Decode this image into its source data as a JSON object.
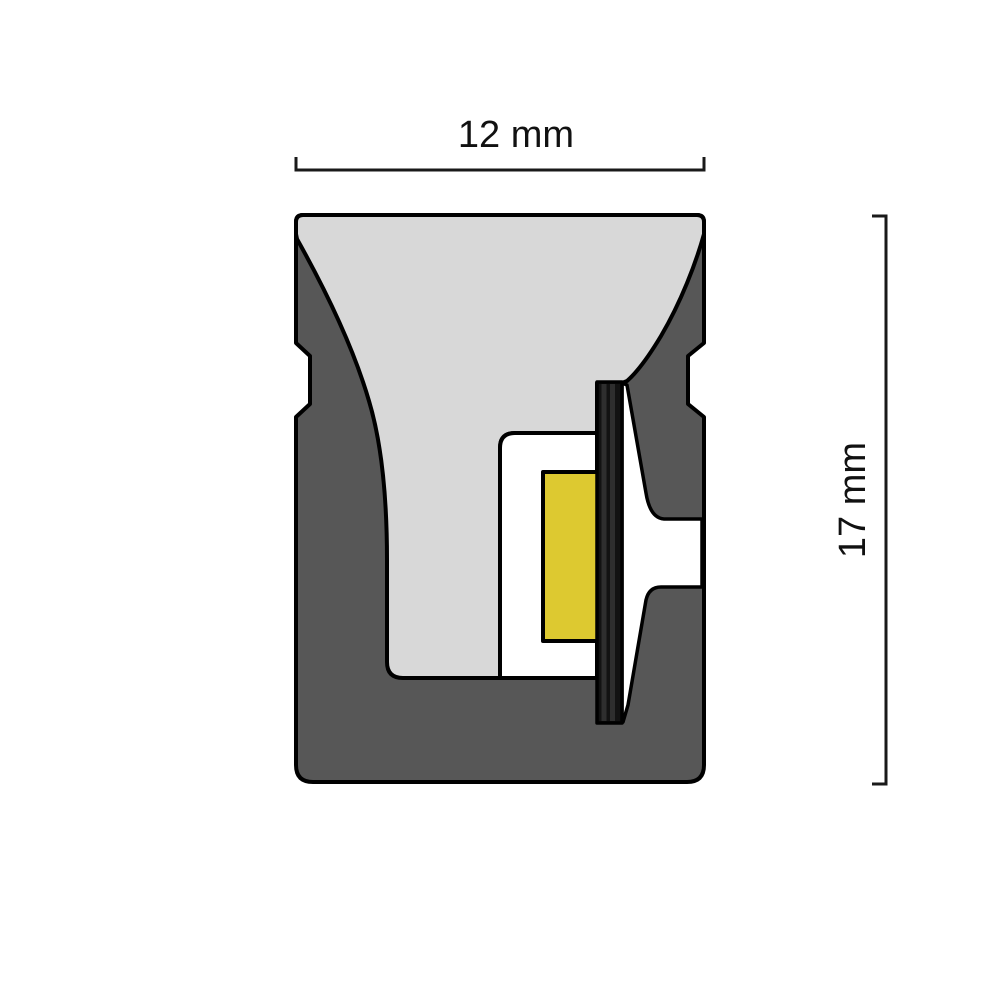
{
  "diagram": {
    "description_label": "led-neon-flex-profile-cross-section",
    "dimensions": {
      "width": {
        "label": "12 mm"
      },
      "height": {
        "label": "17 mm"
      }
    },
    "colors": {
      "background": "#ffffff",
      "outline": "#000000",
      "body_gray": "#575757",
      "diffuser_gray": "#d8d8d8",
      "cavity_white": "#ffffff",
      "led_yellow": "#ddc930",
      "pcb_black": "#121212",
      "pcb_stripe_gray": "#2e2e2e",
      "dimension_line": "#1a1a1a",
      "label_text": "#111111"
    }
  }
}
